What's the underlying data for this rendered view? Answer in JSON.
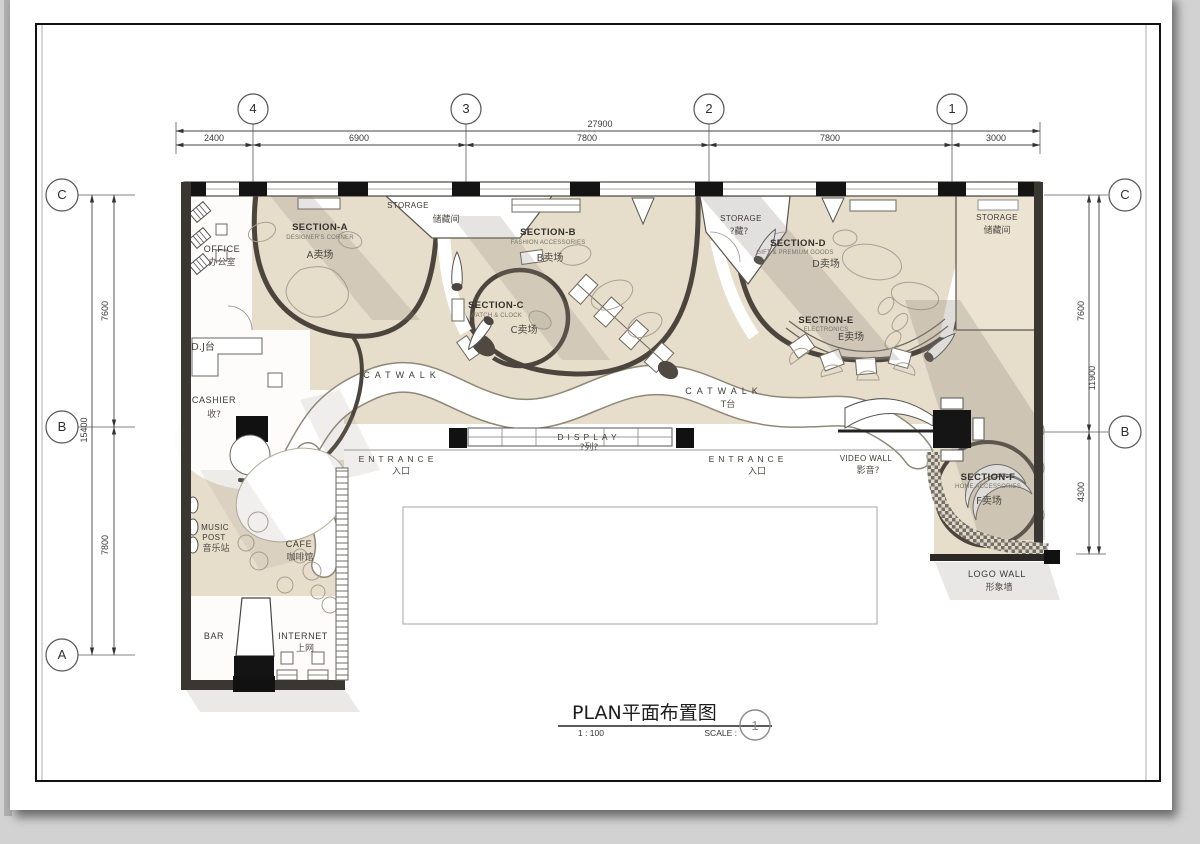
{
  "colors": {
    "canvas": "#d2d2d2",
    "paper": "#ffffff",
    "floor": "#e6ddcb",
    "wall": "#3a3631",
    "plan_line": "#4c453d"
  },
  "grid": {
    "top": [
      "4",
      "3",
      "2",
      "1"
    ],
    "left": [
      "C",
      "B",
      "A"
    ],
    "right": [
      "C",
      "B"
    ]
  },
  "dims": {
    "top_total": "27900",
    "top_segs": [
      "2400",
      "6900",
      "7800",
      "7800",
      "3000"
    ],
    "left_total": "15400",
    "left_segs": [
      "7600",
      "7800"
    ],
    "right_total": "11900",
    "right_segs": [
      "7600",
      "4300"
    ]
  },
  "labels": {
    "storage_a": {
      "en": "STORAGE",
      "cn": "储藏间"
    },
    "storage_mid": {
      "en": "STORAGE",
      "cn": "?藏?"
    },
    "storage_right": {
      "en": "STORAGE",
      "cn": "储藏间"
    },
    "section_a": {
      "en": "SECTION-A",
      "sub": "DESIGNER'S CORNER",
      "cn": "A卖场"
    },
    "section_b": {
      "en": "SECTION-B",
      "sub": "FASHION ACCESSORIES",
      "cn": "B卖场"
    },
    "section_c": {
      "en": "SECTION-C",
      "sub": "WATCH & CLOCK",
      "cn": "C卖场"
    },
    "section_d": {
      "en": "SECTION-D",
      "sub": "GIFT & PREMIUM GOODS",
      "cn": "D卖场"
    },
    "section_e": {
      "en": "SECTION-E",
      "sub": "ELECTRONICS",
      "cn": "E卖场"
    },
    "section_f": {
      "en": "SECTION-F",
      "sub": "HOME ACCESSORIES",
      "cn": "F卖场"
    },
    "office": {
      "en": "OFFICE",
      "cn": "办公室"
    },
    "dj": {
      "en": "D.J台"
    },
    "cashier": {
      "en": "CASHIER",
      "cn": "收?"
    },
    "music_post": {
      "en1": "MUSIC",
      "en2": "POST",
      "cn": "音乐站"
    },
    "cafe": {
      "en": "CAFE",
      "cn": "咖啡馆"
    },
    "bar": {
      "en": "BAR"
    },
    "internet": {
      "en": "INTERNET",
      "cn": "上网"
    },
    "catwalk_left": {
      "en": "CATWALK"
    },
    "catwalk_right": {
      "en": "CATWALK",
      "cn": "T台"
    },
    "display": {
      "en": "DISPLAY",
      "cn": "?列?"
    },
    "entrance_left": {
      "en": "ENTRANCE",
      "cn": "入口"
    },
    "entrance_right": {
      "en": "ENTRANCE",
      "cn": "入口"
    },
    "video_wall": {
      "en": "VIDEO WALL",
      "cn": "影音?"
    },
    "logo_wall": {
      "en": "LOGO WALL",
      "cn": "形象墙"
    }
  },
  "title_block": {
    "title": "PLAN平面布置图",
    "ratio": "1 : 100",
    "scale_label": "SCALE :",
    "number": "1"
  }
}
